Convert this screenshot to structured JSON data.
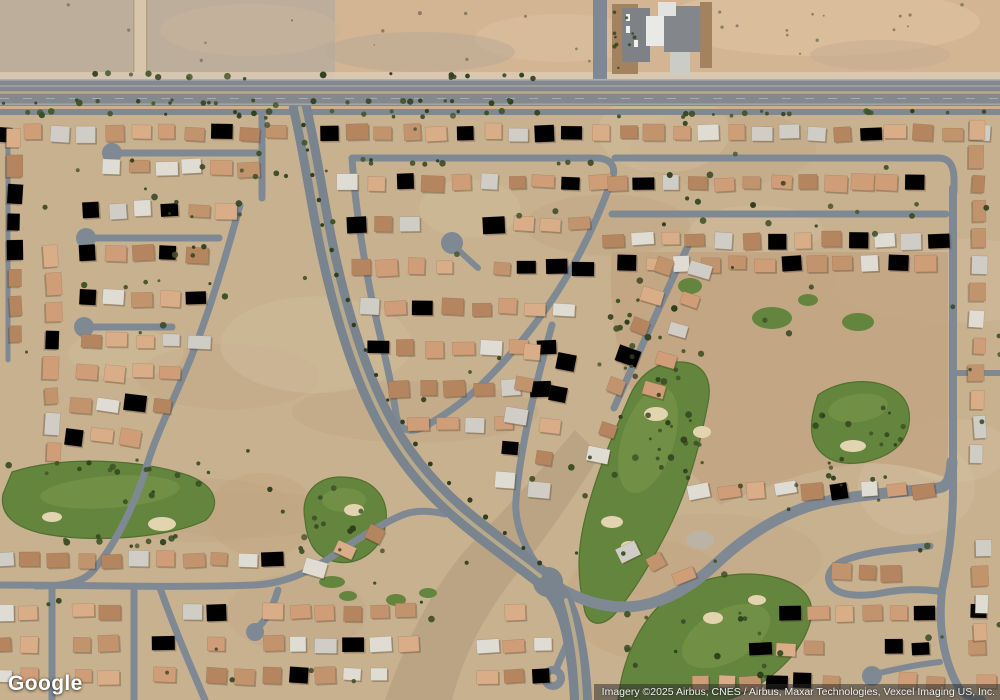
{
  "overlay": {
    "logo": "Google",
    "attribution": "Imagery ©2025 Airbus, CNES / Airbus, Maxar Technologies, Vexcel Imaging US, Inc."
  },
  "map": {
    "view_type": "satellite",
    "visible_features": [
      "desert vacant land",
      "arterial road",
      "suburban residential streets with cul-de-sacs",
      "divided boulevard",
      "golf course fairways and bunkers",
      "commercial building with parking lot"
    ]
  },
  "palette": {
    "ground": "#c8b18f",
    "groundLight": "#d8c6a6",
    "groundDark": "#b59d7a",
    "desert": "#d3b493",
    "desertLeft": "#b9ad9d",
    "desertLight": "#e2c6a4",
    "dirt": "#d9c9b1",
    "track": "#d8c6ac",
    "arterial": "#85898d",
    "road": "#7e8994",
    "median": "#b7a98c",
    "green": "#64853d",
    "greenLight": "#7d9c4e",
    "greenDark": "#50702f",
    "bunker": "#e3d4b0",
    "rough": "#c2a583",
    "wash": "#b49c7d",
    "roofTan1": "#cf9d77",
    "roofTan2": "#d8ad87",
    "roofTan3": "#c2946e",
    "roofBrown": "#b5855f",
    "roofWhite1": "#ecease3",
    "roofWhite2": "#dfdcd3",
    "roofGray": "#cfcdc6",
    "tree": "#3d5026",
    "treeDark": "#2f3f1d",
    "buildingGray": "#83878c",
    "buildingWhite": "#e9eae8",
    "parking": "#7e8287",
    "landscape": "#a3825f",
    "shadow": "rgba(62,42,26,0.28)"
  }
}
